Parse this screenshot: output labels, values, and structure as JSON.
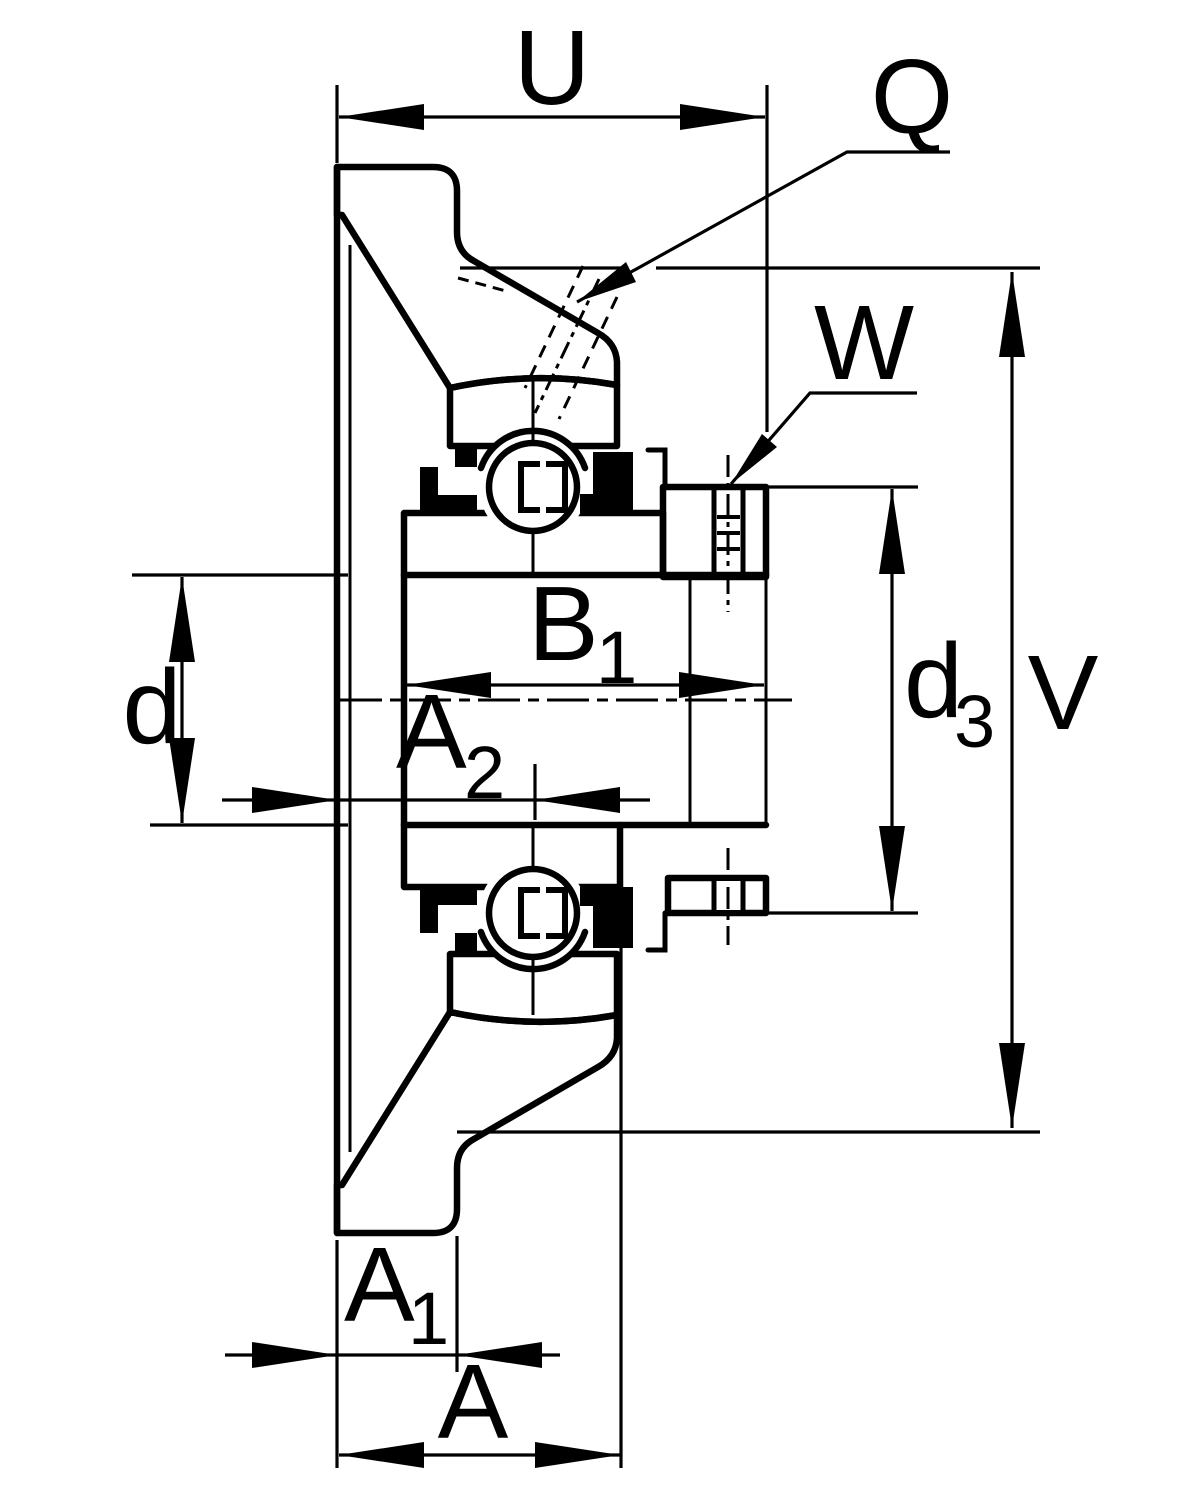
{
  "drawing": {
    "colors": {
      "line": "#000000",
      "background": "#ffffff"
    },
    "dims": {
      "u": {
        "label": "U"
      },
      "q": {
        "label": "Q"
      },
      "w": {
        "label": "W"
      },
      "v": {
        "label": "V"
      },
      "d3": {
        "main": "d",
        "sub": "3"
      },
      "d": {
        "label": "d"
      },
      "b1": {
        "main": "B",
        "sub": "1"
      },
      "a2": {
        "main": "A",
        "sub": "2"
      },
      "a1": {
        "main": "A",
        "sub": "1"
      },
      "a": {
        "label": "A"
      }
    }
  }
}
